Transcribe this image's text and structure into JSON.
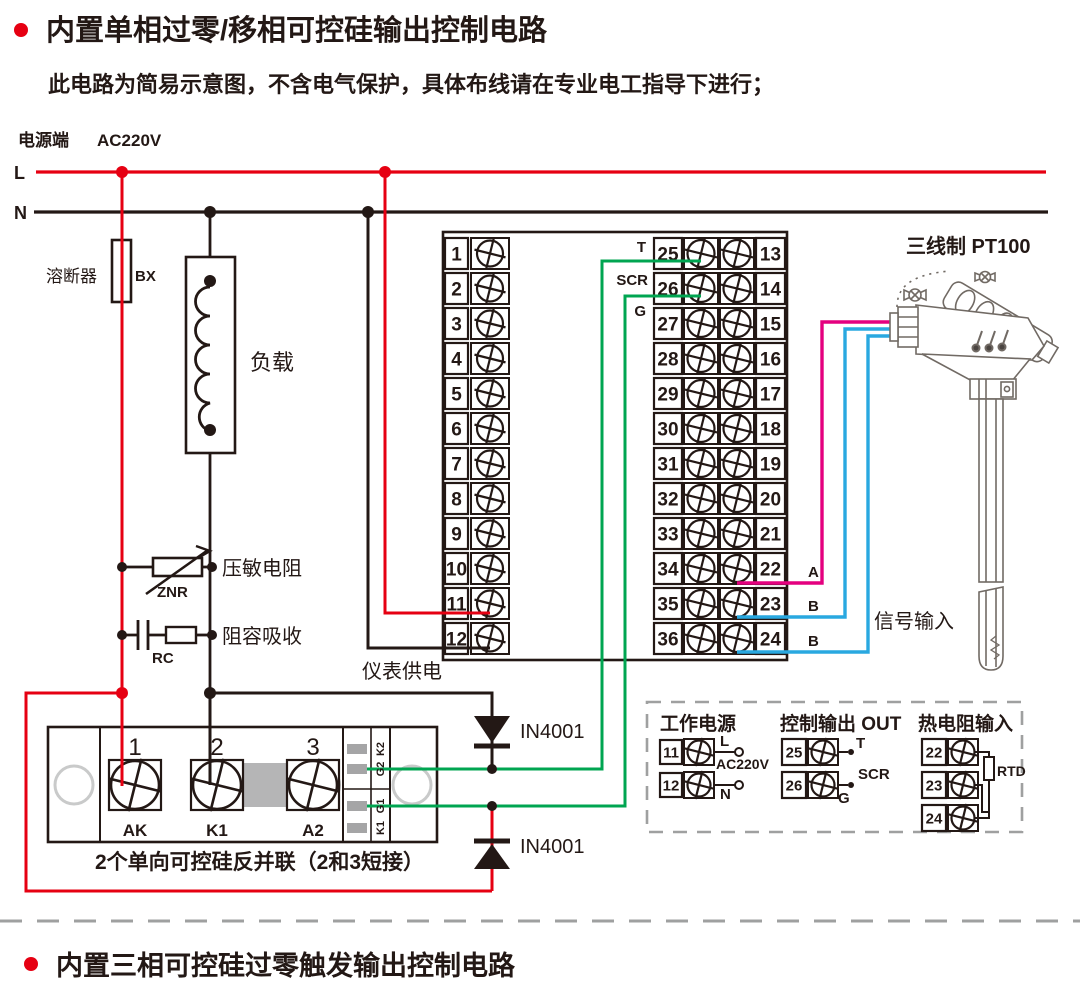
{
  "colors": {
    "red": "#e60012",
    "green": "#00a551",
    "pink": "#e4007f",
    "blue": "#29a8e0",
    "dark": "#231815",
    "gray": "#9fa0a0",
    "bar_gray": "#b5b5b6",
    "pad_gray": "#a5a5a6"
  },
  "header": {
    "title": "内置单相过零/移相可控硅输出控制电路",
    "subtitle": "此电路为简易示意图，不含电气保护，具体布线请在专业电工指导下进行；"
  },
  "footer": {
    "title": "内置三相可控硅过零触发输出控制电路"
  },
  "power": {
    "label": "电源端",
    "voltage": "AC220V",
    "l": "L",
    "n": "N"
  },
  "components": {
    "fuse": "溶断器",
    "fuse_code": "BX",
    "load": "负载",
    "varistor": "压敏电阻",
    "varistor_code": "ZNR",
    "snubber": "阻容吸收",
    "snubber_code": "RC",
    "meter_supply": "仪表供电",
    "diode_top": "IN4001",
    "diode_bottom": "IN4001"
  },
  "scr_module": {
    "terminal_numbers": [
      "1",
      "2",
      "3"
    ],
    "terminal_names": [
      "AK",
      "K1",
      "A2"
    ],
    "gate_labels": [
      "K2",
      "G2",
      "G1",
      "K1"
    ],
    "note": "2个单向可控硅反并联（2和3短接）"
  },
  "terminal_block": {
    "left_numbers": [
      "1",
      "2",
      "3",
      "4",
      "5",
      "6",
      "7",
      "8",
      "9",
      "10",
      "11",
      "12"
    ],
    "inner_numbers": [
      "25",
      "26",
      "27",
      "28",
      "29",
      "30",
      "31",
      "32",
      "33",
      "34",
      "35",
      "36"
    ],
    "outer_numbers": [
      "13",
      "14",
      "15",
      "16",
      "17",
      "18",
      "19",
      "20",
      "21",
      "22",
      "23",
      "24"
    ]
  },
  "signal": {
    "t": "T",
    "scr": "SCR",
    "g": "G",
    "a": "A",
    "b1": "B",
    "b2": "B",
    "label": "信号输入",
    "sensor_title": "三线制 PT100"
  },
  "inset": {
    "power": {
      "title": "工作电源",
      "terminals": [
        "11",
        "12"
      ],
      "l": "L",
      "n": "N",
      "voltage": "AC220V"
    },
    "output": {
      "title": "控制输出 OUT",
      "terminals": [
        "25",
        "26"
      ],
      "t": "T",
      "scr": "SCR",
      "g": "G"
    },
    "rtd": {
      "title": "热电阻输入",
      "terminals": [
        "22",
        "23",
        "24"
      ],
      "label": "RTD"
    }
  }
}
